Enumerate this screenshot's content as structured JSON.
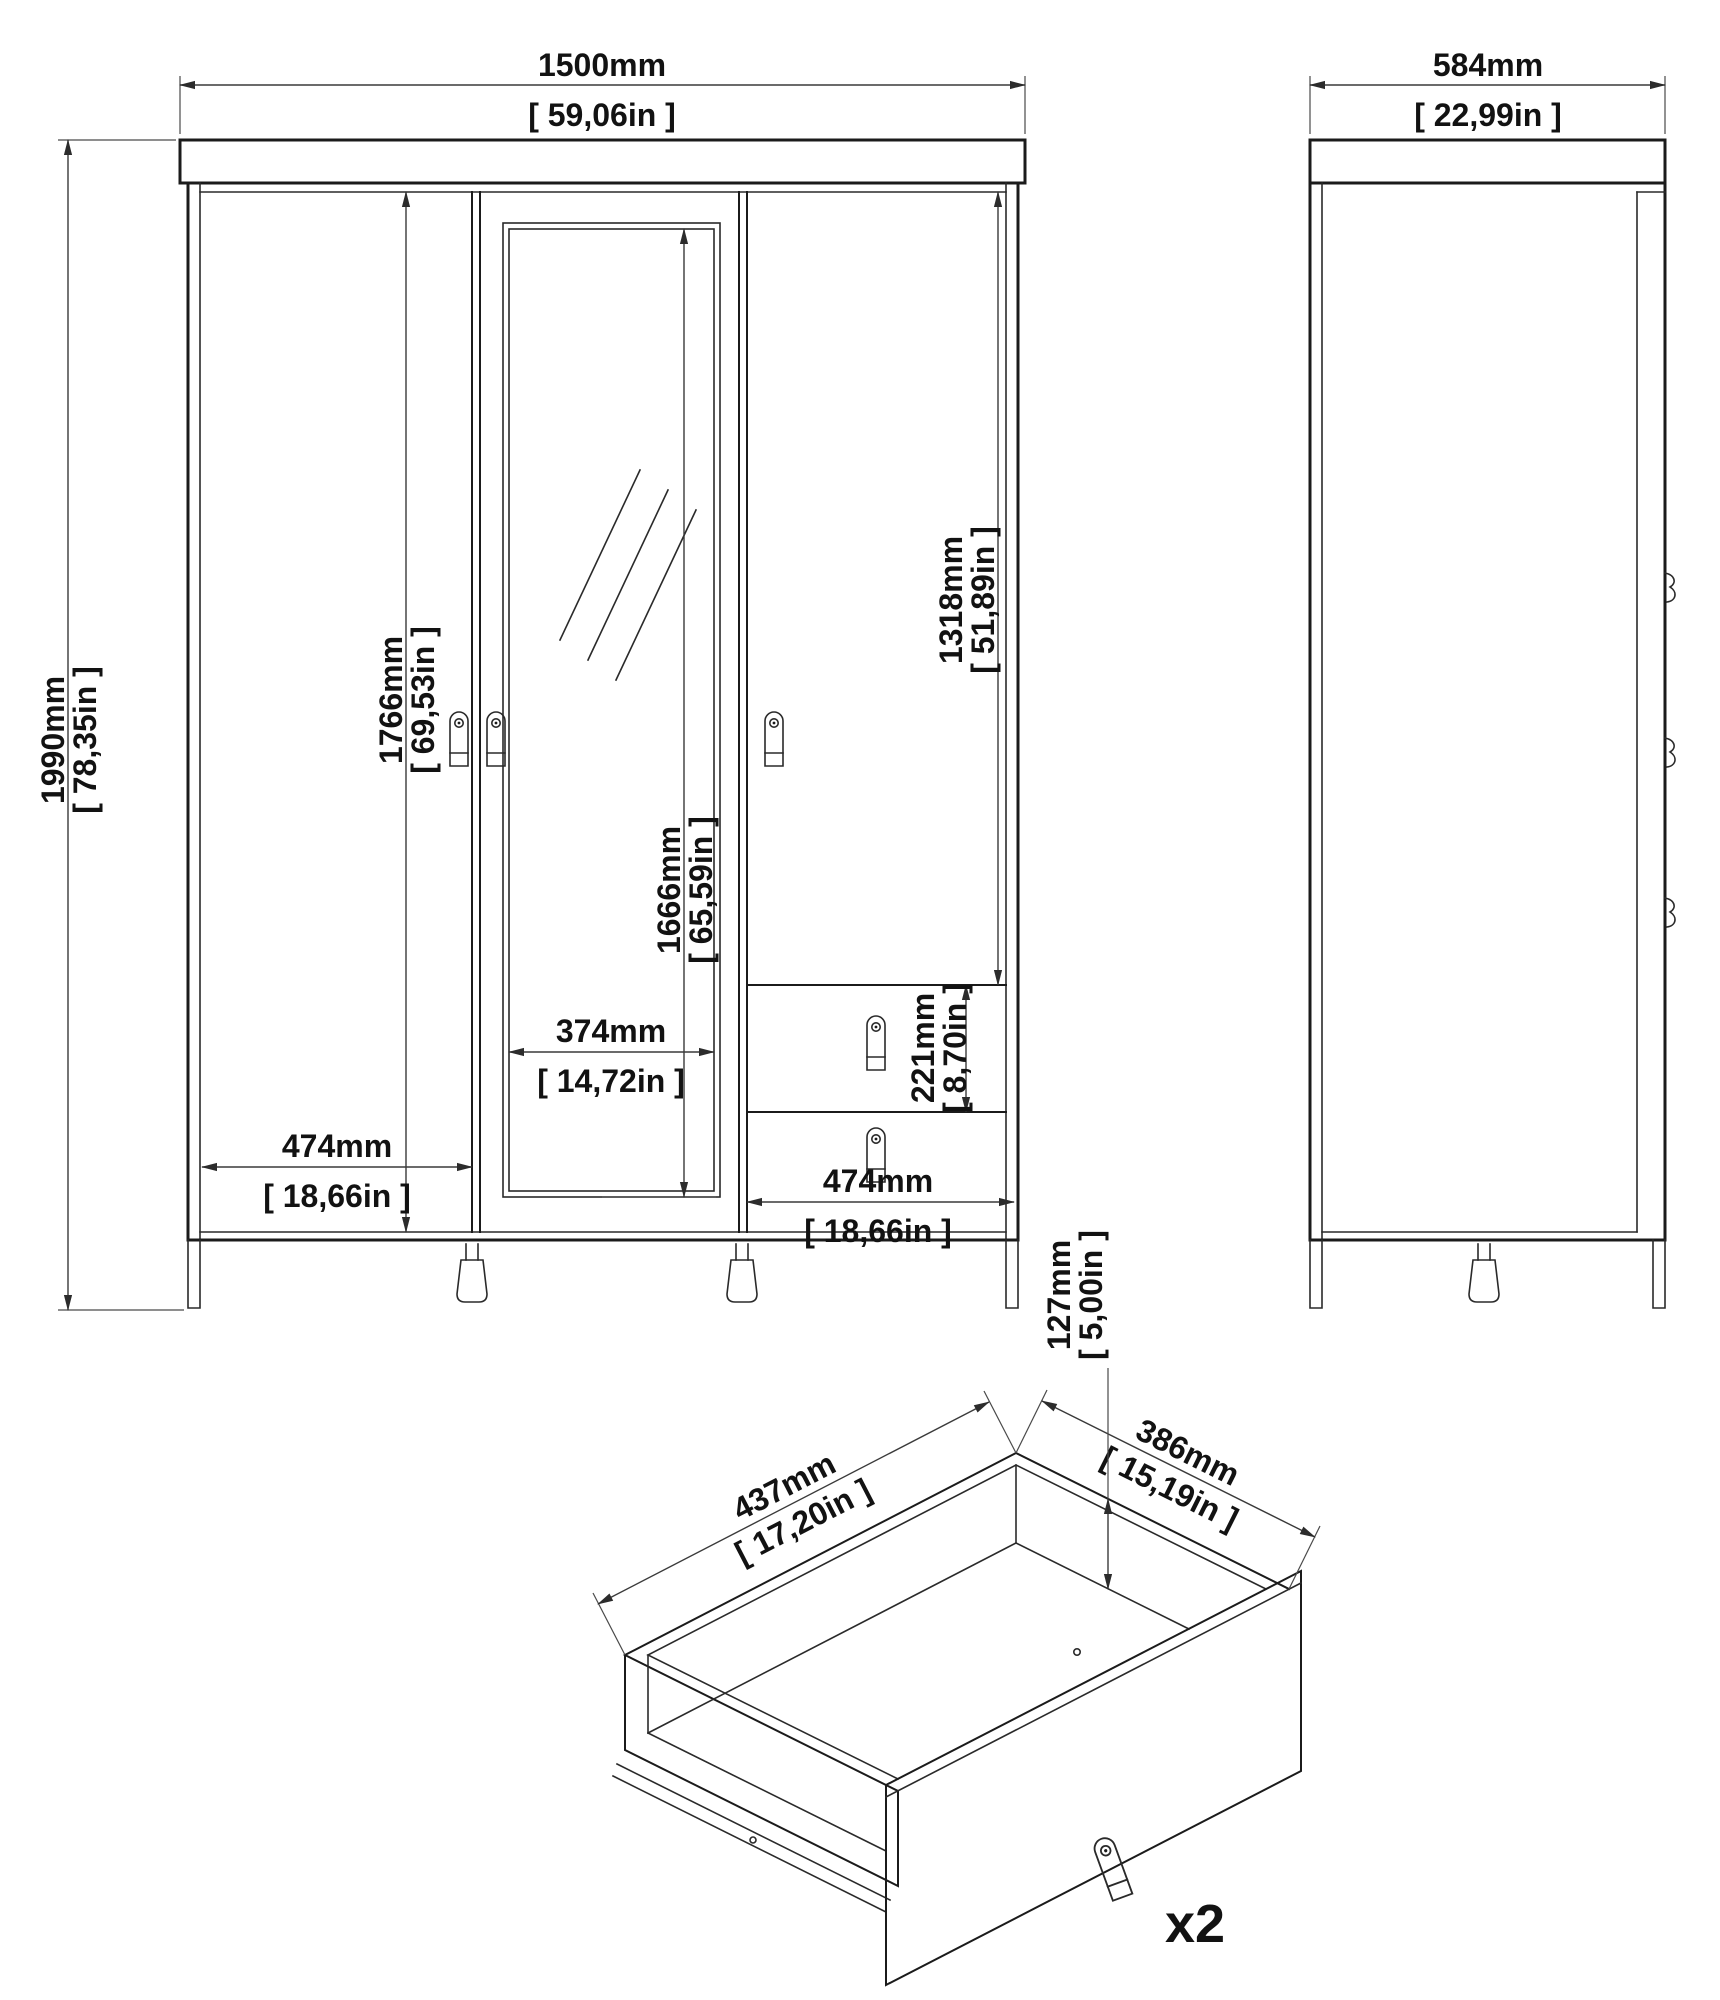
{
  "front_view": {
    "dims": {
      "width_mm": "1500mm",
      "width_in": "[ 59,06in ]",
      "height_mm": "1990mm",
      "height_in": "[ 78,35in ]",
      "door_height_mm": "1766mm",
      "door_height_in": "[ 69,53in ]",
      "mirror_height_mm": "1666mm",
      "mirror_height_in": "[ 65,59in ]",
      "right_door_height_mm": "1318mm",
      "right_door_height_in": "[ 51,89in ]",
      "drawer_height_mm": "221mm",
      "drawer_height_in": "[ 8,70in ]",
      "mirror_width_mm": "374mm",
      "mirror_width_in": "[ 14,72in ]",
      "left_door_width_mm": "474mm",
      "left_door_width_in": "[ 18,66in ]",
      "right_section_width_mm": "474mm",
      "right_section_width_in": "[ 18,66in ]"
    }
  },
  "side_view": {
    "dims": {
      "depth_mm": "584mm",
      "depth_in": "[ 22,99in ]"
    }
  },
  "drawer_detail": {
    "dims": {
      "width_mm": "437mm",
      "width_in": "[ 17,20in ]",
      "depth_mm": "386mm",
      "depth_in": "[ 15,19in ]",
      "height_mm": "127mm",
      "height_in": "[ 5,00in ]"
    },
    "quantity_label": "x2"
  },
  "colors": {
    "line": "#1b1b1b",
    "dim_line": "#3a3a3a",
    "text": "#121212",
    "background": "#ffffff"
  }
}
